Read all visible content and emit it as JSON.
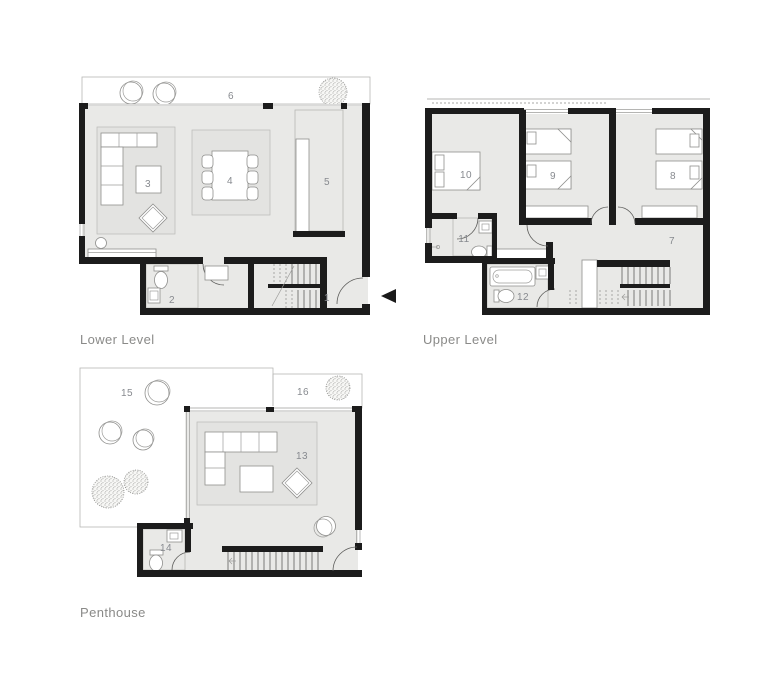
{
  "colors": {
    "background": "#ffffff",
    "wall": "#1c1c1c",
    "floor": "#e9e9e7",
    "rug": "#e3e3e1",
    "hatch_line": "#c5c5c2",
    "tile_line": "#bdbdbb",
    "furniture_line": "#8f8f8d",
    "label_text": "#8a8a88",
    "number_text": "#878a8f"
  },
  "marker": {
    "icon": "left-arrow"
  },
  "plans": {
    "lower": {
      "label": "Lower Level",
      "room_numbers": [
        "1",
        "2",
        "3",
        "4",
        "5",
        "6"
      ]
    },
    "upper": {
      "label": "Upper Level",
      "room_numbers": [
        "7",
        "8",
        "9",
        "10",
        "11",
        "12"
      ]
    },
    "penthouse": {
      "label": "Penthouse",
      "room_numbers": [
        "13",
        "14",
        "15",
        "16"
      ]
    }
  }
}
